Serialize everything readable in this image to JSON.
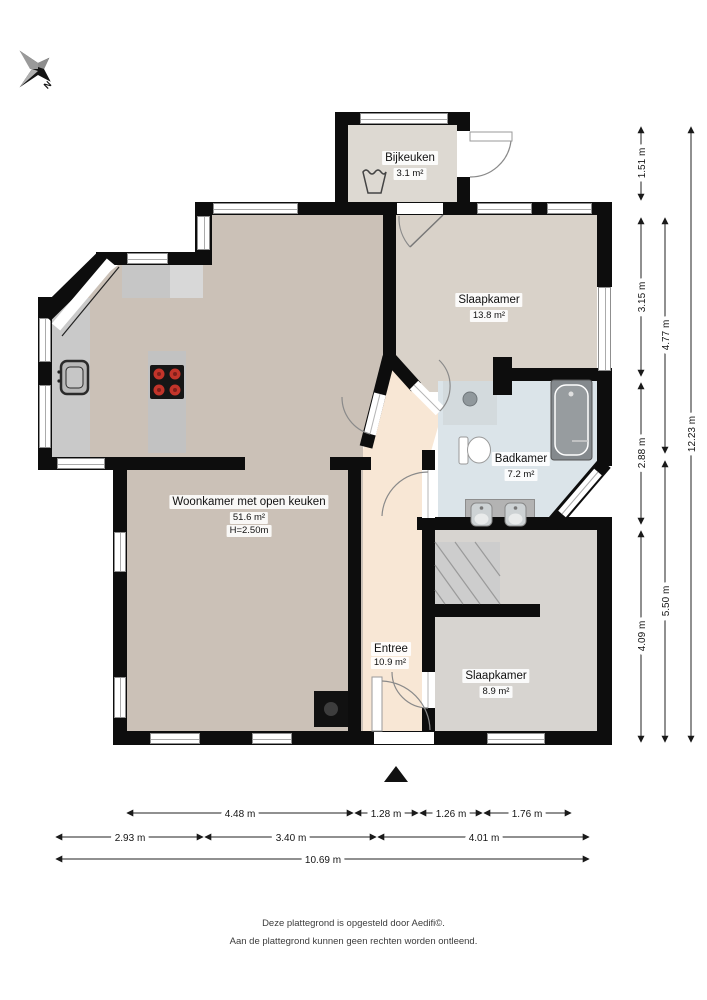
{
  "compass": {
    "label": "N"
  },
  "rooms": {
    "bijkeuken": {
      "name": "Bijkeuken",
      "area": "3.1 m²"
    },
    "slaapkamer_1": {
      "name": "Slaapkamer",
      "area": "13.8 m²"
    },
    "woonkamer": {
      "name": "Woonkamer met open keuken",
      "area": "51.6 m²",
      "ceiling_height": "H=2.50m"
    },
    "badkamer": {
      "name": "Badkamer",
      "area": "7.2 m²"
    },
    "entree": {
      "name": "Entree",
      "area": "10.9 m²"
    },
    "slaapkamer_2": {
      "name": "Slaapkamer",
      "area": "8.9 m²"
    }
  },
  "dimensions": {
    "right": {
      "col1": [
        "1.51 m",
        "3.15 m",
        "2.88 m",
        "4.09 m"
      ],
      "col2": [
        "4.77 m",
        "5.50 m"
      ],
      "col3": [
        "12.23 m"
      ]
    },
    "bottom": {
      "row1": [
        "4.48 m",
        "1.28 m",
        "1.26 m",
        "1.76 m"
      ],
      "row2": [
        "2.93 m",
        "3.40 m",
        "4.01 m"
      ],
      "row3": [
        "10.69 m"
      ]
    }
  },
  "footer": {
    "line1": "Deze plattegrond is opgesteld door Aedifi©.",
    "line2": "Aan de plattegrond kunnen geen rechten worden ontleend."
  },
  "colors": {
    "wall": "#0d0d0d",
    "woonkamer_floor": "#cbc1b7",
    "slaapkamer1_floor": "#d9d2c9",
    "bijkeuken_floor": "#ddd9d2",
    "entree_floor": "#f8e7d5",
    "badkamer_floor": "#dbe4e9",
    "slaapkamer2_floor": "#d7d4d0",
    "counter": "#c8c8c8",
    "stove_burner": "#c2342a"
  }
}
